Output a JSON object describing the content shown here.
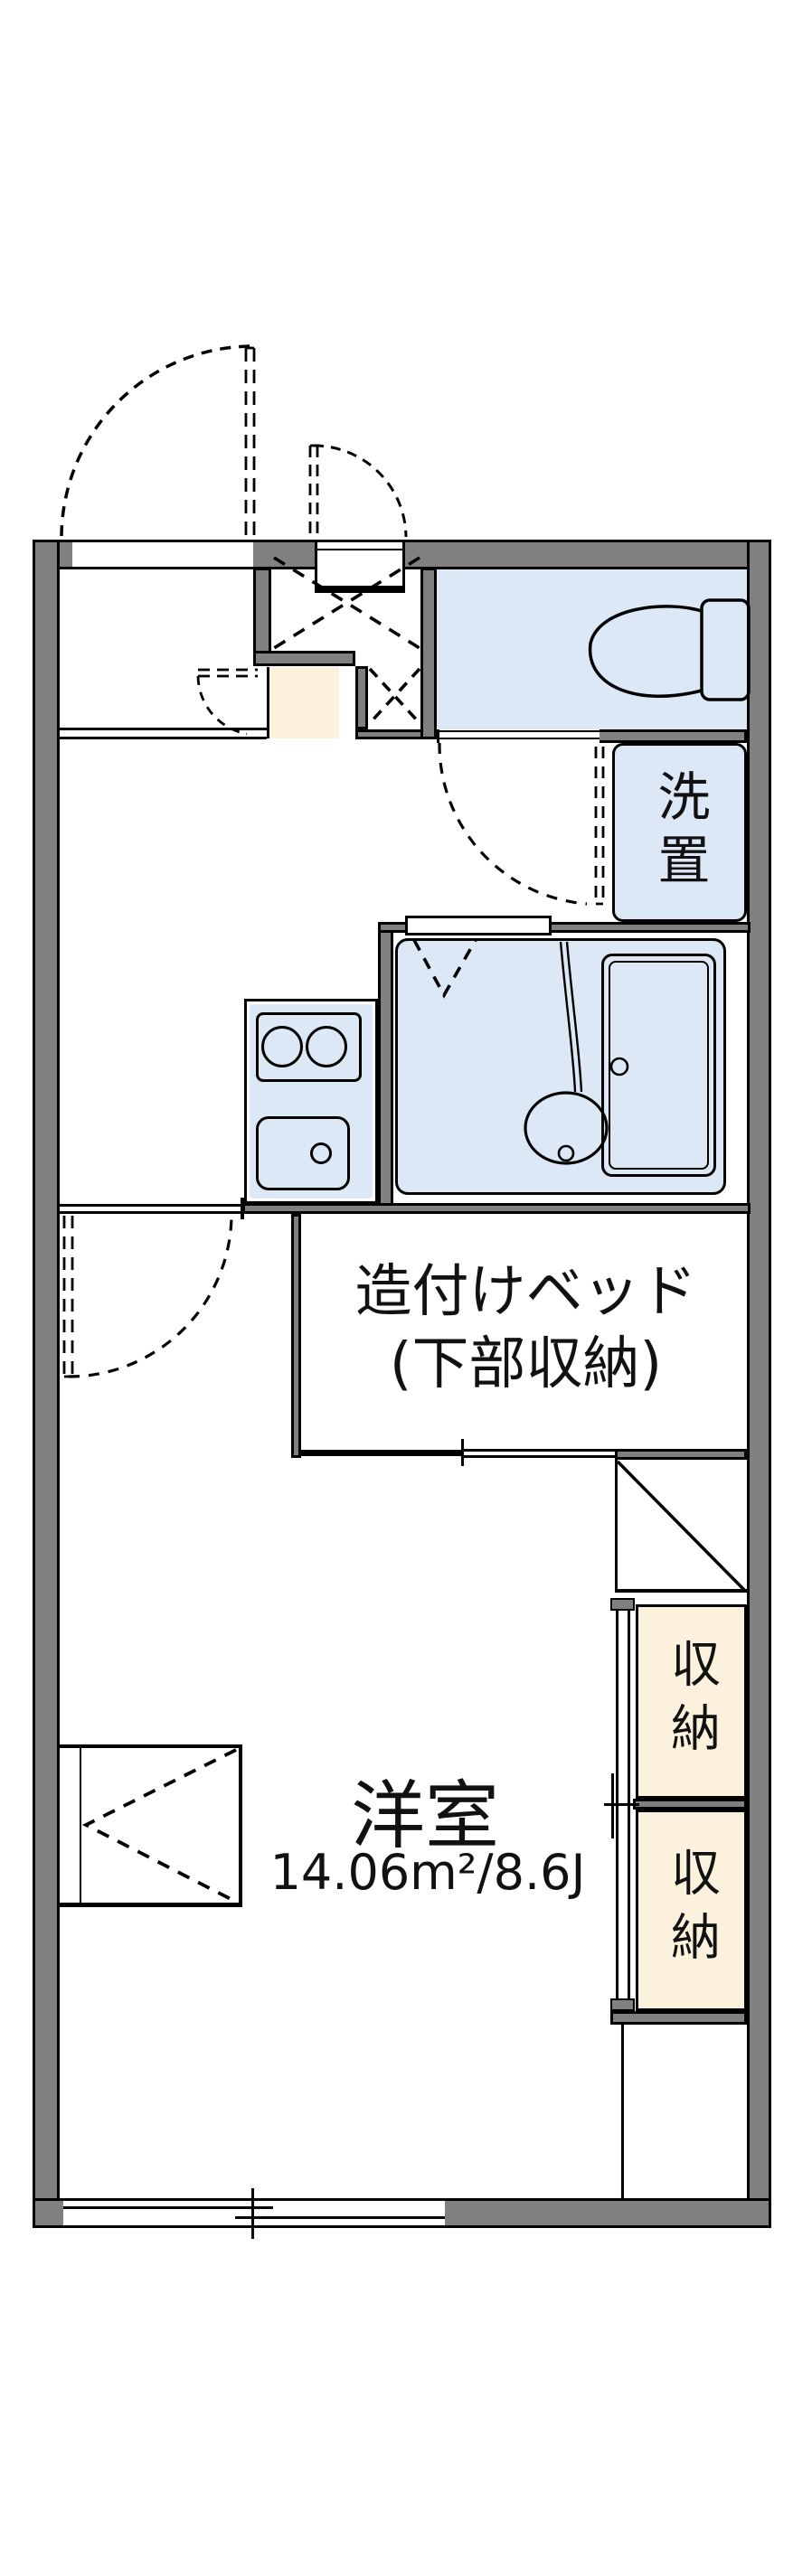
{
  "floorplan": {
    "rooms": {
      "western_room": {
        "name": "洋室",
        "area": "14.06m²/8.6J"
      },
      "built_in_bed": {
        "line1": "造付けベッド",
        "line2": "(下部収納)"
      },
      "washer_space": {
        "name": "洗置"
      },
      "storage_upper": {
        "name": "収納"
      },
      "storage_lower": {
        "name": "収納"
      }
    },
    "colors": {
      "wall_gray": "#808080",
      "wet_area_blue": "#dde8f7",
      "step_cream": "#fbf1dc",
      "line_black": "#000000",
      "background": "#ffffff"
    }
  }
}
